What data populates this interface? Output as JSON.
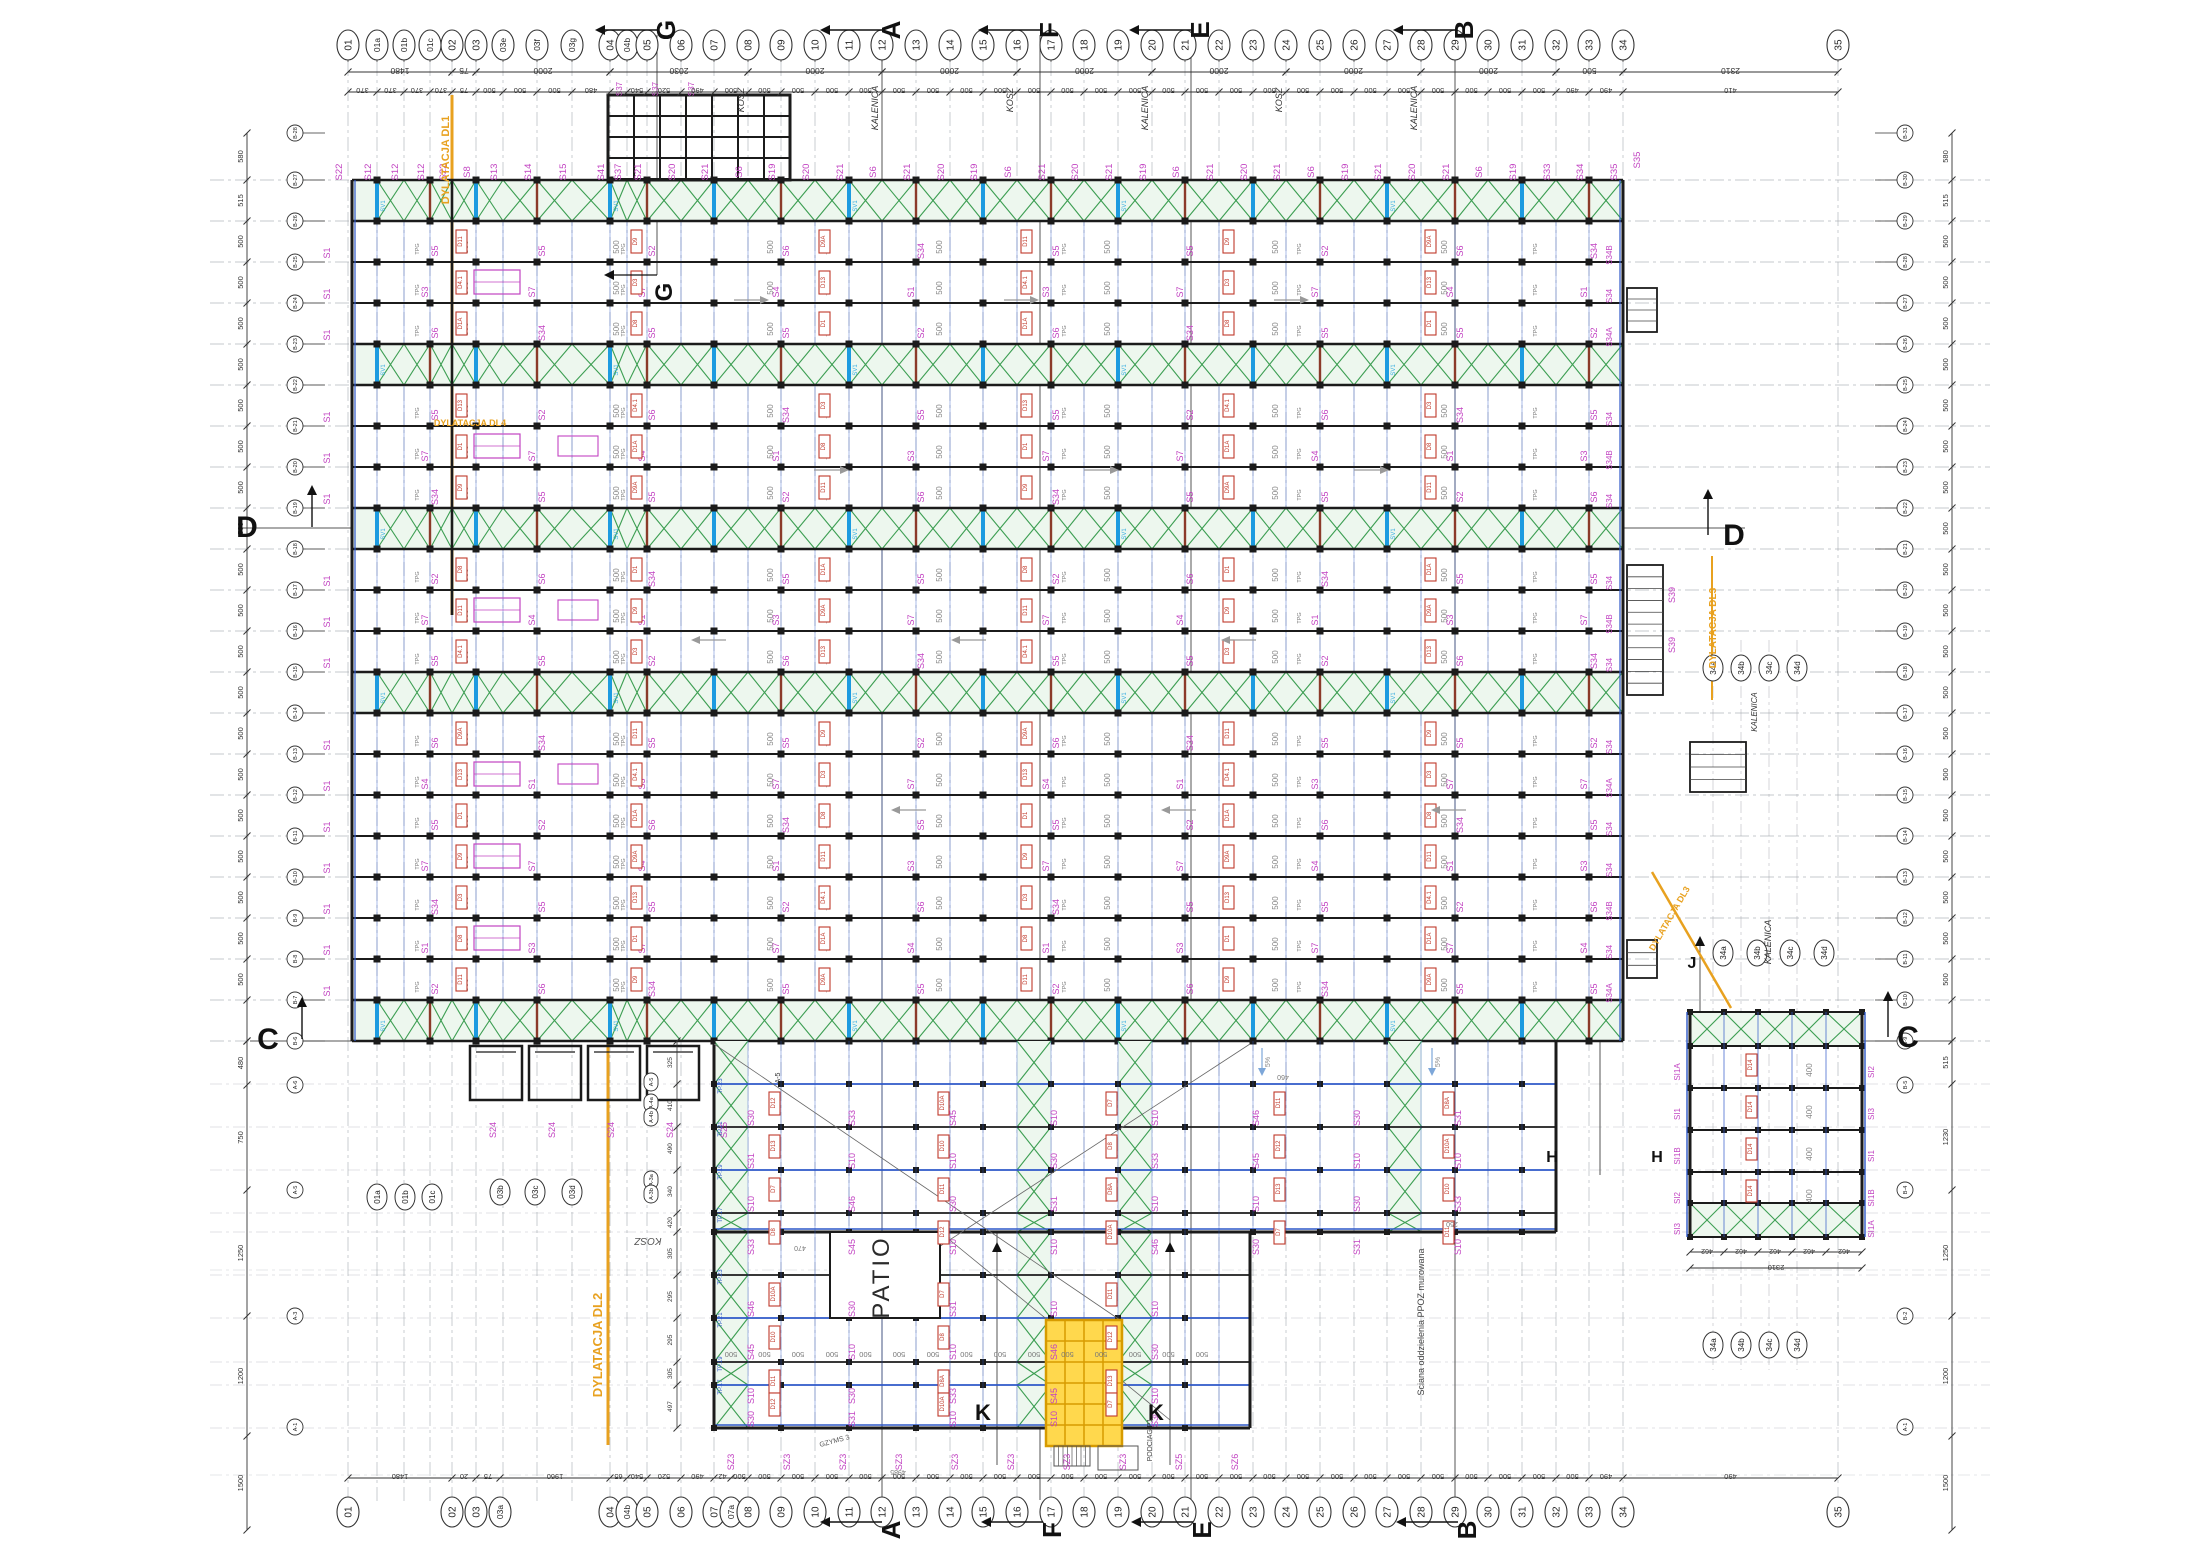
{
  "page": {
    "title": "Rzut konstrukcji stalowej — plan montazowy",
    "bg": "#FFFFFF"
  },
  "colors": {
    "black": "#1b1b1b",
    "gray": "#8a8f96",
    "dim": "#6d7177",
    "faint": "#9aa0a6",
    "magenta": "#c244c2",
    "red": "#c0392b",
    "darkred": "#8b3a2a",
    "green": "#3c9e52",
    "greenfill": "#edf7ee",
    "blue": "#2e58c8",
    "brightblue": "#1d9be0",
    "cyan": "#35aee2",
    "orange": "#e8a11f",
    "yellow": "#ffd84d",
    "yellowedge": "#d79b00"
  },
  "axes_top": [
    [
      "01",
      348
    ],
    [
      "01a",
      377
    ],
    [
      "01b",
      404
    ],
    [
      "01c",
      430
    ],
    [
      "02",
      452
    ],
    [
      "03",
      476
    ],
    [
      "03e",
      503
    ],
    [
      "03f",
      537
    ],
    [
      "03g",
      572
    ],
    [
      "04",
      610
    ],
    [
      "04b",
      627
    ],
    [
      "05",
      647
    ],
    [
      "06",
      681
    ],
    [
      "07",
      714
    ],
    [
      "08",
      748
    ],
    [
      "09",
      781
    ],
    [
      "10",
      815
    ],
    [
      "11",
      849
    ],
    [
      "12",
      882
    ],
    [
      "13",
      916
    ],
    [
      "14",
      950
    ],
    [
      "15",
      983
    ],
    [
      "16",
      1017
    ],
    [
      "17",
      1051
    ],
    [
      "18",
      1084
    ],
    [
      "19",
      1118
    ],
    [
      "20",
      1152
    ],
    [
      "21",
      1185
    ],
    [
      "22",
      1219
    ],
    [
      "23",
      1253
    ],
    [
      "24",
      1286
    ],
    [
      "25",
      1320
    ],
    [
      "26",
      1354
    ],
    [
      "27",
      1387
    ],
    [
      "28",
      1421
    ],
    [
      "29",
      1455
    ],
    [
      "30",
      1488
    ],
    [
      "31",
      1522
    ],
    [
      "32",
      1556
    ],
    [
      "33",
      1589
    ],
    [
      "34",
      1623
    ],
    [
      "35",
      1838
    ]
  ],
  "axes_bottom": [
    [
      "01",
      348
    ],
    [
      "02",
      452
    ],
    [
      "03",
      476
    ],
    [
      "03a",
      500
    ],
    [
      "04",
      610
    ],
    [
      "04b",
      627
    ],
    [
      "05",
      647
    ],
    [
      "06",
      681
    ],
    [
      "07",
      714
    ],
    [
      "07a",
      731
    ],
    [
      "08",
      748
    ],
    [
      "09",
      781
    ],
    [
      "10",
      815
    ],
    [
      "11",
      849
    ],
    [
      "12",
      882
    ],
    [
      "13",
      916
    ],
    [
      "14",
      950
    ],
    [
      "15",
      983
    ],
    [
      "16",
      1017
    ],
    [
      "17",
      1051
    ],
    [
      "18",
      1084
    ],
    [
      "19",
      1118
    ],
    [
      "20",
      1152
    ],
    [
      "21",
      1185
    ],
    [
      "22",
      1219
    ],
    [
      "23",
      1253
    ],
    [
      "24",
      1286
    ],
    [
      "25",
      1320
    ],
    [
      "26",
      1354
    ],
    [
      "27",
      1387
    ],
    [
      "28",
      1421
    ],
    [
      "29",
      1455
    ],
    [
      "30",
      1488
    ],
    [
      "31",
      1522
    ],
    [
      "32",
      1556
    ],
    [
      "33",
      1589
    ],
    [
      "34",
      1623
    ],
    [
      "35",
      1838
    ]
  ],
  "rows": {
    "start": 180,
    "step": 41,
    "count": 22
  },
  "left_bubbles": {
    "x": 295,
    "top_y": 133,
    "labels": [
      "B-28",
      "B-27",
      "B-26",
      "B-25",
      "B-24",
      "B-23",
      "B-22",
      "B-21",
      "B-20",
      "B-19",
      "B-18",
      "B-17",
      "B-16",
      "B-15",
      "B-14",
      "B-13",
      "B-12",
      "B-11",
      "B-10",
      "B-9",
      "B-8",
      "B-7",
      "B-6"
    ]
  },
  "right_bubbles": {
    "x": 1905,
    "labels": [
      "B-31",
      "B-30",
      "B-29",
      "B-28",
      "B-27",
      "B-26",
      "B-25",
      "B-24",
      "B-23",
      "B-22",
      "B-21",
      "B-20",
      "B-19",
      "B-18",
      "B-17",
      "B-16",
      "B-15",
      "B-14",
      "B-13",
      "B-12",
      "B-11",
      "B-10",
      "B-9"
    ]
  },
  "lower_left_bubbles": [
    [
      "A-6",
      1085
    ],
    [
      "A-5",
      1190
    ],
    [
      "A-3",
      1316
    ],
    [
      "A-1",
      1427
    ]
  ],
  "lower_right_bubbles": [
    [
      "B-5",
      1085
    ],
    [
      "B-4",
      1190
    ],
    [
      "B-2",
      1316
    ],
    [
      "A-1",
      1427
    ]
  ],
  "interior_bubbles": [
    [
      "01a",
      377,
      1197
    ],
    [
      "01b",
      405,
      1197
    ],
    [
      "01c",
      432,
      1197
    ],
    [
      "03b",
      500,
      1192
    ],
    [
      "03c",
      535,
      1192
    ],
    [
      "03d",
      572,
      1192
    ],
    [
      "34a",
      1713,
      668
    ],
    [
      "34b",
      1741,
      668
    ],
    [
      "34c",
      1769,
      668
    ],
    [
      "34d",
      1797,
      668
    ],
    [
      "34a",
      1723,
      953
    ],
    [
      "34b",
      1757,
      953
    ],
    [
      "34c",
      1790,
      953
    ],
    [
      "34d",
      1824,
      953
    ],
    [
      "34a",
      1713,
      1345
    ],
    [
      "34b",
      1741,
      1345
    ],
    [
      "34c",
      1769,
      1345
    ],
    [
      "34d",
      1797,
      1345
    ]
  ],
  "pills": [
    [
      "A-5",
      651,
      1082
    ],
    [
      "A-4a",
      651,
      1103
    ],
    [
      "A-4b",
      651,
      1117
    ],
    [
      "A-3a",
      651,
      1180
    ],
    [
      "A-3b",
      651,
      1194
    ]
  ],
  "hall": {
    "x1": 352,
    "x2": 1623,
    "band_gaps": [
      0,
      4,
      8,
      12,
      20
    ]
  },
  "wing": {
    "x1": 714,
    "x2": 1250,
    "east_x2": 1556,
    "y1": 1041,
    "y2": 1428,
    "east_y2": 1232,
    "rows": [
      [
        1084,
        "blue"
      ],
      [
        1127,
        "black"
      ],
      [
        1170,
        "blue"
      ],
      [
        1213,
        "black"
      ],
      [
        1232,
        "edge"
      ],
      [
        1275,
        "black"
      ],
      [
        1318,
        "blue"
      ],
      [
        1362,
        "black"
      ],
      [
        1385,
        "blue"
      ],
      [
        1428,
        "edge"
      ]
    ],
    "vbands": [
      [
        714,
        748
      ],
      [
        1017,
        1051
      ],
      [
        1118,
        1152
      ],
      [
        1388,
        1422
      ]
    ]
  },
  "block": {
    "cols": [
      1690,
      1724,
      1758,
      1792,
      1826,
      1862
    ],
    "rows": [
      1012,
      1046,
      1088,
      1130,
      1172,
      1203,
      1237
    ]
  },
  "patio": {
    "x1": 830,
    "y1": 1232,
    "x2": 940,
    "y2": 1318,
    "label": "PATIO"
  },
  "core": {
    "x1": 1046,
    "y1": 1320,
    "x2": 1122,
    "y2": 1446
  },
  "mezz": {
    "x": 608,
    "y": 95,
    "w": 182,
    "h": 85,
    "labels": [
      "S37",
      "S37",
      "S37"
    ]
  },
  "canopy": {
    "xs": [
      470,
      529,
      588,
      647
    ],
    "w": 52,
    "y": 1046,
    "h": 54,
    "labels": [
      "S24",
      "S24",
      "S24",
      "S24",
      "S25"
    ]
  },
  "stairs": [
    {
      "x": 1627,
      "y": 565,
      "w": 36,
      "h": 130,
      "n": 11,
      "label": "S39"
    },
    {
      "x": 1627,
      "y": 288,
      "w": 30,
      "h": 44,
      "n": 4,
      "label": ""
    },
    {
      "x": 1627,
      "y": 940,
      "w": 30,
      "h": 38,
      "n": 3,
      "label": ""
    },
    {
      "x": 1690,
      "y": 742,
      "w": 56,
      "h": 50,
      "n": 4,
      "label": ""
    }
  ],
  "dims": {
    "top_major": [
      [
        348,
        452,
        "1480"
      ],
      [
        452,
        476,
        "75"
      ],
      [
        476,
        610,
        "2000"
      ],
      [
        610,
        748,
        "2030"
      ],
      [
        748,
        882,
        "2000"
      ],
      [
        882,
        1017,
        "2000"
      ],
      [
        1017,
        1152,
        "2000"
      ],
      [
        1152,
        1286,
        "2000"
      ],
      [
        1286,
        1421,
        "2000"
      ],
      [
        1421,
        1556,
        "2000"
      ],
      [
        1556,
        1623,
        "500"
      ],
      [
        1623,
        1838,
        "2310"
      ]
    ],
    "top_minor_special": {
      "0": "370",
      "1": "370",
      "2": "370",
      "3": "370",
      "4": "75",
      "8": "480",
      "9": "",
      "10": "540",
      "11": "520",
      "12": "490",
      "38": "490",
      "39": "490",
      "40": "410"
    },
    "top_minor_default": "500",
    "bottom_special": {
      "0": "1480",
      "1": "20",
      "2": "75",
      "3": "1960",
      "4": "65",
      "5": "540",
      "6": "520",
      "7": "490",
      "8": "42",
      "35": "490",
      "36": "490",
      "37": "410"
    },
    "bottom_default": "500",
    "left_upper": [
      "580",
      "515",
      "500",
      "500",
      "500",
      "500",
      "500",
      "500",
      "500",
      "500",
      "500",
      "500",
      "500",
      "500",
      "500",
      "500",
      "500",
      "500",
      "500",
      "500",
      "500"
    ],
    "left_lower": [
      "480",
      "750",
      "1250",
      "1200",
      "1500"
    ],
    "left_lower_ys": [
      1041,
      1085,
      1190,
      1316,
      1436,
      1530
    ],
    "right_upper": [
      "580",
      "515",
      "500",
      "500",
      "500",
      "500",
      "500",
      "500",
      "500",
      "500",
      "500",
      "500",
      "500",
      "500",
      "500",
      "500",
      "500",
      "500",
      "500",
      "500",
      "500"
    ],
    "right_lower": [
      "515",
      "1230",
      "1250",
      "1200",
      "1500"
    ],
    "right_lower_ys": [
      1041,
      1084,
      1190,
      1316,
      1436,
      1530
    ],
    "wing_col_x": 677,
    "wing_col": [
      "325",
      "410",
      "490",
      "340",
      "420",
      "305",
      "295",
      "295",
      "305",
      "497",
      "500",
      "503"
    ],
    "block_bottom": [
      "462",
      "462",
      "462",
      "462",
      "462"
    ],
    "block_total": "2310",
    "wing_row_y": 1352,
    "wing_row_label": "500",
    "misc": [
      [
        "470",
        800,
        1246
      ],
      [
        "460",
        1283,
        1075
      ],
      [
        "250",
        1452,
        1222
      ],
      [
        "4985",
        898,
        1470
      ]
    ]
  },
  "markers": {
    "top": [
      [
        "G",
        657
      ],
      [
        "A",
        882
      ],
      [
        "F",
        1040
      ],
      [
        "E",
        1191
      ],
      [
        "B",
        1455
      ]
    ],
    "bottom": [
      [
        "A",
        882
      ],
      [
        "F",
        1043
      ],
      [
        "E",
        1193
      ],
      [
        "B",
        1458
      ]
    ],
    "left": [
      [
        "D",
        247,
        537,
        312
      ],
      [
        "C",
        268,
        1049,
        302
      ]
    ],
    "right": [
      [
        "D",
        1734,
        545,
        1708
      ],
      [
        "C",
        1908,
        1047,
        1888
      ]
    ],
    "inner_g": {
      "label": "G",
      "x": 672,
      "y": 292
    },
    "k": [
      [
        "K",
        983,
        1420,
        997
      ],
      [
        "K",
        1156,
        1420,
        1170
      ]
    ],
    "h": [
      [
        "H",
        1552,
        1162
      ],
      [
        "H",
        1657,
        1162
      ]
    ],
    "j": {
      "label": "J",
      "x": 1692,
      "y": 968
    }
  },
  "cut_lines": [
    [
      882,
      35,
      882,
      1500
    ],
    [
      1040,
      35,
      1040,
      1500
    ],
    [
      1191,
      35,
      1191,
      1500
    ],
    [
      1455,
      35,
      1455,
      1500
    ],
    [
      657,
      35,
      657,
      275
    ],
    [
      997,
      1232,
      997,
      1465
    ],
    [
      1170,
      1232,
      1170,
      1465
    ],
    [
      1600,
      1041,
      1600,
      1175
    ],
    [
      1700,
      940,
      1700,
      1012
    ],
    [
      238,
      528,
      352,
      528
    ],
    [
      1623,
      528,
      1745,
      528
    ],
    [
      250,
      1041,
      352,
      1041
    ],
    [
      1862,
      1041,
      1952,
      1041
    ]
  ],
  "labels": {
    "s_top": [
      "S22",
      "S12",
      "S12",
      "S12",
      "S22",
      "S8",
      "S13",
      "S14",
      "S15",
      "S41",
      "S37",
      "S21",
      "S20",
      "S21",
      "S6",
      "S19",
      "S20",
      "S21",
      "S6",
      "S21",
      "S20",
      "S19",
      "S6",
      "S21",
      "S20",
      "S21",
      "S19",
      "S6",
      "S21",
      "S20",
      "S21",
      "S6",
      "S19",
      "S21",
      "S20",
      "S21",
      "S6",
      "S19",
      "S33",
      "S34",
      "S35"
    ],
    "s_hall": [
      "S1",
      "S2",
      "S7",
      "S5",
      "S3",
      "S6",
      "S4",
      "S5",
      "S7",
      "S34"
    ],
    "d_hall": [
      "D1",
      "D9",
      "D3",
      "D8",
      "D11",
      "D4.1",
      "D1A",
      "D9A",
      "D13"
    ],
    "s_left_col": "S1",
    "s_right_col": [
      "S34",
      "S34B",
      "S34",
      "S34A",
      "S34B",
      "S34",
      "S34B",
      "S34",
      "S34A",
      "S34",
      "S34B",
      "S34",
      "S34B",
      "S34",
      "S34A",
      "S34"
    ],
    "tpg": "TPG",
    "sv": "SV1",
    "num": "500",
    "s_wing": [
      "S10",
      "S30",
      "S31",
      "S10",
      "S33",
      "S10",
      "S46",
      "S45",
      "S10",
      "S30"
    ],
    "d_wing": [
      "D10",
      "D11",
      "D12",
      "D13",
      "D7",
      "D8",
      "D8A",
      "D10A"
    ],
    "tp_wing": [
      "TP.23",
      "TP.21",
      "TP.19",
      "TP.17",
      "TP.15"
    ],
    "sz_row": [
      "SZ3",
      "SZ3",
      "SZ3",
      "SZ3",
      "SZ3",
      "SZ3",
      "SZ3",
      "SZ3",
      "SZ5",
      "SZ6"
    ],
    "si_block": [
      "SI1A",
      "SI1",
      "SI1B",
      "SI2",
      "SI3",
      "SI1",
      "SI1B"
    ],
    "d_block": "D14",
    "num_block": "400",
    "slope": "5%"
  },
  "texts": [
    {
      "t": "PATIO",
      "x": 889,
      "y": 1277,
      "rot": -90,
      "size": 24,
      "color": "#2b2b2b",
      "ls": 3,
      "name": "patio-label"
    },
    {
      "t": "KOSZ",
      "x": 744,
      "y": 100,
      "rot": -90,
      "size": 9,
      "italic": true,
      "color": "#333",
      "name": "kosz-label"
    },
    {
      "t": "KOSZ",
      "x": 1013,
      "y": 100,
      "rot": -90,
      "size": 9,
      "italic": true,
      "color": "#333",
      "name": "kosz-label"
    },
    {
      "t": "KOSZ",
      "x": 1282,
      "y": 100,
      "rot": -90,
      "size": 9,
      "italic": true,
      "color": "#333",
      "name": "kosz-label"
    },
    {
      "t": "KALENICA",
      "x": 878,
      "y": 108,
      "rot": -90,
      "size": 9,
      "italic": true,
      "color": "#333",
      "name": "kalenica-label"
    },
    {
      "t": "KALENICA",
      "x": 1148,
      "y": 108,
      "rot": -90,
      "size": 9,
      "italic": true,
      "color": "#333",
      "name": "kalenica-label"
    },
    {
      "t": "KALENICA",
      "x": 1417,
      "y": 108,
      "rot": -90,
      "size": 9,
      "italic": true,
      "color": "#333",
      "name": "kalenica-label"
    },
    {
      "t": "KALENICA",
      "x": 1771,
      "y": 942,
      "rot": -90,
      "size": 9,
      "italic": true,
      "color": "#333",
      "name": "kalenica-label"
    },
    {
      "t": "KALENICA",
      "x": 1757,
      "y": 712,
      "rot": -90,
      "size": 8,
      "italic": true,
      "color": "#333",
      "name": "kalenica-label"
    },
    {
      "t": "KOSZ",
      "x": 648,
      "y": 1238,
      "rot": 180,
      "size": 10,
      "italic": true,
      "color": "#555",
      "name": "kosz-label"
    },
    {
      "t": "DYLATACJA DL1",
      "x": 449,
      "y": 160,
      "rot": -90,
      "size": 11,
      "color": "#e8a11f",
      "bold": true,
      "name": "dylatacja-dl1-label"
    },
    {
      "t": "DYLATACJA DL2",
      "x": 602,
      "y": 1345,
      "rot": -90,
      "size": 13,
      "color": "#e8a11f",
      "bold": true,
      "name": "dylatacja-dl2-label"
    },
    {
      "t": "DYLATACJA DL3",
      "x": 1716,
      "y": 628,
      "rot": -90,
      "size": 10,
      "color": "#e8a11f",
      "bold": true,
      "name": "dylatacja-dl3-label"
    },
    {
      "t": "DYLATACJA DL3",
      "x": 1672,
      "y": 920,
      "rot": -60,
      "size": 9,
      "color": "#e8a11f",
      "bold": true,
      "name": "dylatacja-dl3-label"
    },
    {
      "t": "DYLATACJA DL4",
      "x": 470,
      "y": 426,
      "rot": 0,
      "size": 9,
      "color": "#e8a11f",
      "bold": true,
      "name": "dylatacja-dl4-label"
    },
    {
      "t": "Sciana oddzielenia PPOZ murowana",
      "x": 1424,
      "y": 1322,
      "rot": -90,
      "size": 9,
      "color": "#444",
      "name": "ppoz-wall-label"
    },
    {
      "t": "PODCIAG P1",
      "x": 1152,
      "y": 1440,
      "rot": -90,
      "size": 7,
      "color": "#444",
      "name": "podciag-label"
    },
    {
      "t": "GZYMS 3",
      "x": 835,
      "y": 1443,
      "rot": -15,
      "size": 7,
      "color": "#555",
      "name": "gzyms-label"
    },
    {
      "t": "A-5",
      "x": 780,
      "y": 1078,
      "rot": -90,
      "size": 7,
      "color": "#333",
      "name": "ref-label"
    }
  ],
  "slope_arrows": [
    [
      760,
      300,
      "r"
    ],
    [
      1030,
      300,
      "r"
    ],
    [
      1300,
      300,
      "r"
    ],
    [
      840,
      470,
      "r"
    ],
    [
      1110,
      470,
      "r"
    ],
    [
      1380,
      470,
      "r"
    ],
    [
      700,
      640,
      "l"
    ],
    [
      960,
      640,
      "l"
    ],
    [
      1230,
      640,
      "l"
    ],
    [
      900,
      810,
      "l"
    ],
    [
      1170,
      810,
      "l"
    ],
    [
      1440,
      810,
      "l"
    ],
    [
      1262,
      1068,
      "d"
    ],
    [
      1432,
      1068,
      "d"
    ]
  ],
  "diagonals": [
    [
      714,
      1044,
      1120,
      1320
    ],
    [
      1250,
      1044,
      830,
      1318
    ],
    [
      940,
      1232,
      1170,
      1420
    ]
  ]
}
